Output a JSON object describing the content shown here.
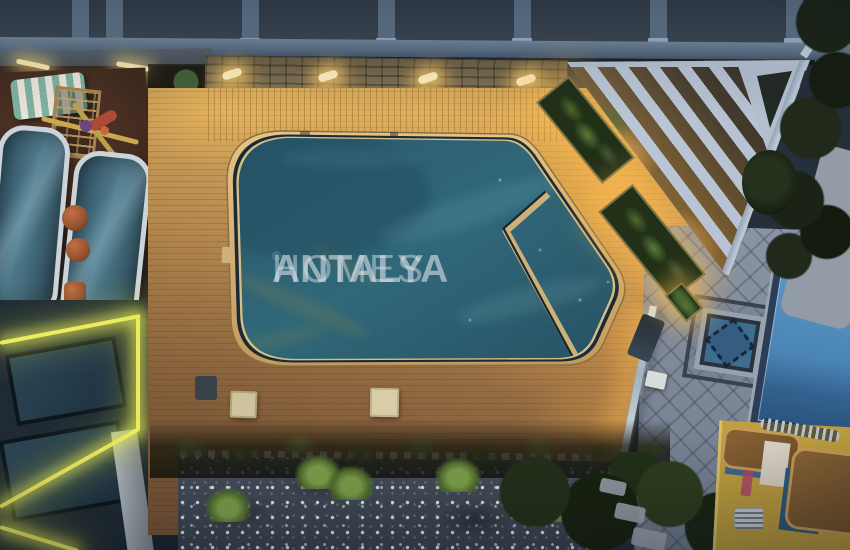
{
  "watermark": {
    "brand_primary": "ANTALYA",
    "brand_secondary": "HOMES",
    "registered_mark": "®"
  },
  "palette": {
    "water": "#2f6678",
    "water_deep": "#27546​6",
    "rim_tan": "#d9b97a",
    "channel_dark": "#1b2a36",
    "deck_lit": "#cb9f58",
    "deck_shadow": "#8a6a42",
    "glow_gold": "#ffc05a",
    "neon_yellow": "#ecec5f",
    "pergola_white": "#b7c3d3",
    "stone_wall": "#7a6c50",
    "roof_panel": "#3c4855",
    "roof_frame": "#74889d",
    "pavement": "#7e8899",
    "neighbor_pool_blue": "#4a84b4",
    "mosaic_pool_blue": "#3e6d92",
    "gravel_base": "#3e4853",
    "gravel_dot": "#ebf0f3",
    "foliage": "#4d682e",
    "foliage_bright": "#7fa24b",
    "building_yellow": "#bf9f3e",
    "canopy_glass": "#507d8d",
    "watermark_color": "#e0e7ed"
  }
}
